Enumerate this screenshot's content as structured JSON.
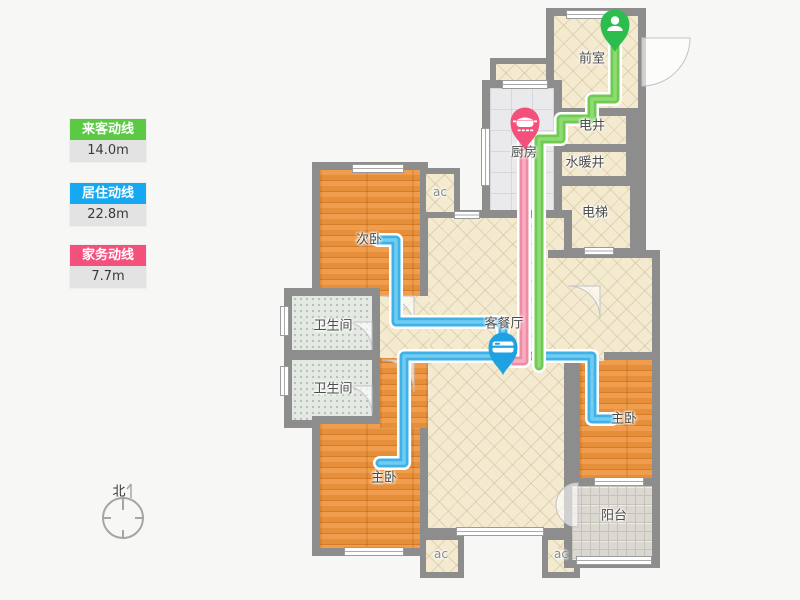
{
  "legend": {
    "items": [
      {
        "label": "来客动线",
        "value": "14.0m",
        "color": "#5bc944"
      },
      {
        "label": "居住动线",
        "value": "22.8m",
        "color": "#16a9f1"
      },
      {
        "label": "家务动线",
        "value": "7.7m",
        "color": "#f4507c"
      }
    ]
  },
  "compass": {
    "label": "北"
  },
  "rooms": {
    "qianshi": {
      "label": "前室"
    },
    "dianjing": {
      "label": "电井"
    },
    "shuinuanjing": {
      "label": "水暖井"
    },
    "dianti": {
      "label": "电梯"
    },
    "chufang": {
      "label": "厨房"
    },
    "ciwo": {
      "label": "次卧"
    },
    "weishengjian": {
      "label": "卫生间"
    },
    "keting": {
      "label": "客餐厅"
    },
    "zhuwo": {
      "label": "主卧"
    },
    "yangtai": {
      "label": "阳台"
    },
    "ac": {
      "label": "ac"
    }
  },
  "lines": {
    "visitor": {
      "color": "#6fcb52",
      "highlight": "#9ade7f",
      "path": "M615 46 V99 H592 V119 H561 V139 H539 V366"
    },
    "resident": {
      "color": "#3eb2e6",
      "highlight": "#7dd2f5",
      "path1": "M378 240 H396 V322 H503 V356",
      "path2": "M380 463 H404 V356 H592 V419 H612"
    },
    "housework": {
      "color": "#f08ba6",
      "highlight": "#f9b6c9",
      "path": "M524 142 V361 H506",
      "cap_color": "#b168a2"
    }
  },
  "pins": {
    "visitor": {
      "color": "#2dbd4f"
    },
    "kitchen": {
      "color": "#f4507c"
    },
    "living": {
      "color": "#1ea2e2"
    }
  }
}
